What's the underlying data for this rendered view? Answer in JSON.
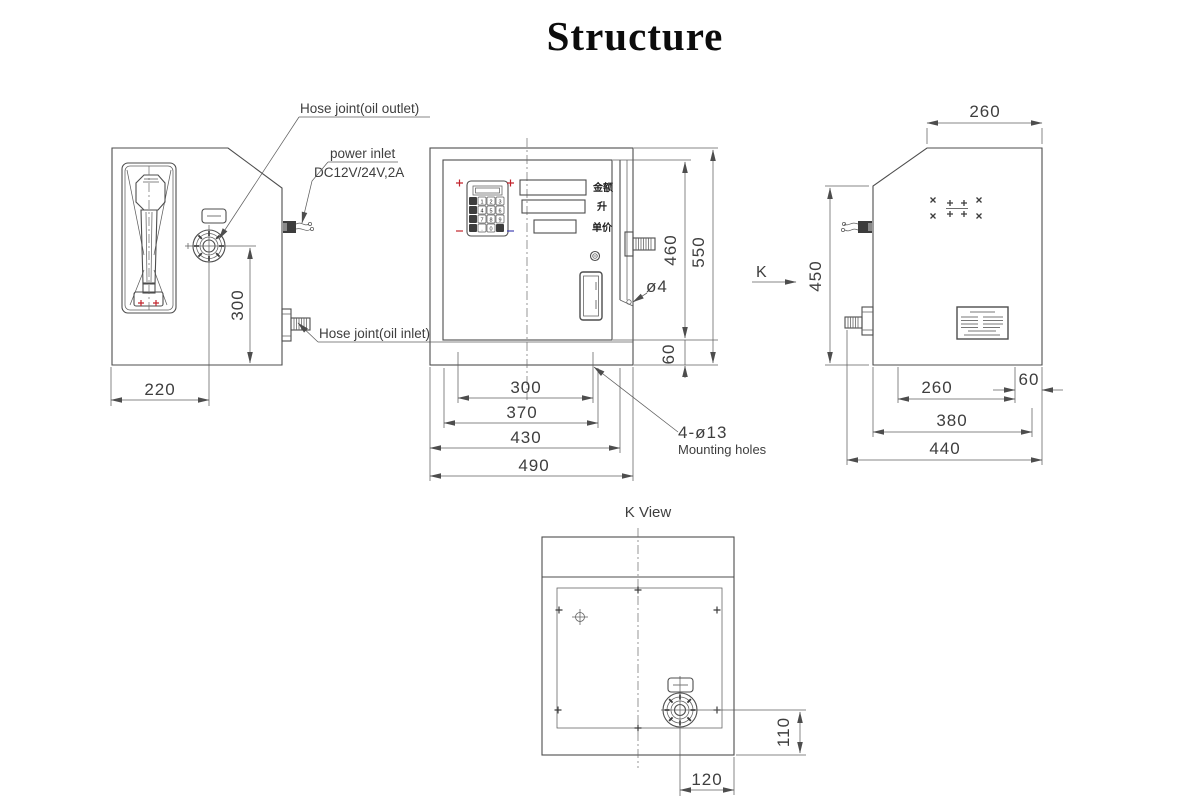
{
  "title": "Structure",
  "colors": {
    "line": "#4d4d4d",
    "dim_line": "#5f5f5f",
    "text": "#3e3e3e",
    "accent_red": "#c2242c",
    "accent_blue": "#4343b2"
  },
  "left_view": {
    "labels": {
      "hose_outlet": "Hose joint(oil outlet)",
      "power_inlet": "power inlet",
      "power_spec": "DC12V/24V,2A",
      "hose_inlet": "Hose joint(oil inlet)"
    },
    "dims": {
      "d300": "300",
      "d220": "220"
    }
  },
  "front_view": {
    "displays": {
      "amount": "金额",
      "volume": "升",
      "unit_price": "单价"
    },
    "keypad": [
      "1",
      "2",
      "3",
      "4",
      "5",
      "6",
      "7",
      "8",
      "9",
      ".",
      "0"
    ],
    "dims": {
      "d300": "300",
      "d370": "370",
      "d430": "430",
      "d490": "490",
      "d460": "460",
      "d550": "550",
      "d60": "60",
      "hole": "ø4"
    },
    "callout": {
      "line1": "4-ø13",
      "line2": "Mounting holes"
    }
  },
  "right_view": {
    "view_label": "K",
    "dims": {
      "top260": "260",
      "d450": "450",
      "b260": "260",
      "b60": "60",
      "b380": "380",
      "b440": "440"
    }
  },
  "k_view": {
    "title": "K View",
    "dims": {
      "d110": "110",
      "d120": "120"
    }
  }
}
